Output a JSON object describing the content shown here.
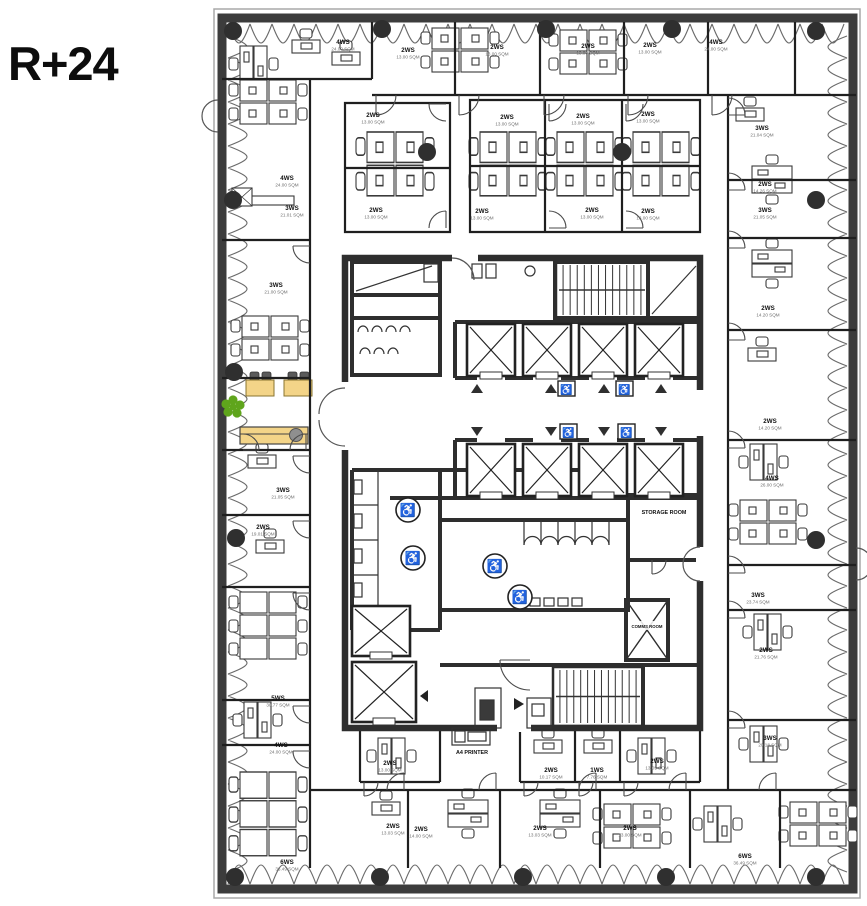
{
  "floor_label": "R+24",
  "colors": {
    "wall": "#3c3c3c",
    "frame": "#a8a8a8",
    "partition": "#1f1f1f",
    "core_wall": "#2e2e2e",
    "window_line": "#6a6a6a",
    "column": "#2f2f2f",
    "desk_line": "#3a3a3a",
    "door_line": "#4a4a4a",
    "highlight_fill": "#f3d488",
    "highlight_stroke": "#b99b45",
    "chair_dark": "#5a5a5a",
    "chair_gray": "#8f8f8f",
    "marker_green": "#5fa51c",
    "text_dark": "#111111",
    "text_gray": "#6f6f6f"
  },
  "core_labels": {
    "storage": "STORAGE ROOM",
    "comms": "COMMS ROOM",
    "printer": "A4 PRINTER"
  },
  "icons": {
    "wheelchair": "♿",
    "elevator_up": "up-triangle",
    "elevator_down": "down-triangle"
  },
  "rooms": [
    {
      "l": "4WS",
      "a": "24.00 SQM",
      "x": 343,
      "y": 44
    },
    {
      "l": "2WS",
      "a": "13.00 SQM",
      "x": 408,
      "y": 52
    },
    {
      "l": "2WS",
      "a": "13.00 SQM",
      "x": 497,
      "y": 49
    },
    {
      "l": "2WS",
      "a": "13.00 SQM",
      "x": 588,
      "y": 48
    },
    {
      "l": "2WS",
      "a": "13.00 SQM",
      "x": 650,
      "y": 47
    },
    {
      "l": "4WS",
      "a": "24.00 SQM",
      "x": 716,
      "y": 44
    },
    {
      "l": "2WS",
      "a": "13.00 SQM",
      "x": 373,
      "y": 117
    },
    {
      "l": "2WS",
      "a": "13.00 SQM",
      "x": 376,
      "y": 212
    },
    {
      "l": "2WS",
      "a": "13.00 SQM",
      "x": 507,
      "y": 119
    },
    {
      "l": "2WS",
      "a": "13.00 SQM",
      "x": 583,
      "y": 118
    },
    {
      "l": "2WS",
      "a": "13.00 SQM",
      "x": 648,
      "y": 116
    },
    {
      "l": "2WS",
      "a": "13.00 SQM",
      "x": 482,
      "y": 213
    },
    {
      "l": "2WS",
      "a": "13.00 SQM",
      "x": 592,
      "y": 212
    },
    {
      "l": "2WS",
      "a": "13.00 SQM",
      "x": 648,
      "y": 213
    },
    {
      "l": "4WS",
      "a": "24.00 SQM",
      "x": 287,
      "y": 180
    },
    {
      "l": "3WS",
      "a": "21.01 SQM",
      "x": 292,
      "y": 210
    },
    {
      "l": "3WS",
      "a": "21.00 SQM",
      "x": 276,
      "y": 287
    },
    {
      "l": "3WS",
      "a": "21.05 SQM",
      "x": 283,
      "y": 492
    },
    {
      "l": "2WS",
      "a": "19.01 SQM",
      "x": 263,
      "y": 529
    },
    {
      "l": "5WS",
      "a": "30.77 SQM",
      "x": 278,
      "y": 700
    },
    {
      "l": "4WS",
      "a": "24.00 SQM",
      "x": 281,
      "y": 747
    },
    {
      "l": "6WS",
      "a": "36.49 SQM",
      "x": 287,
      "y": 864
    },
    {
      "l": "3WS",
      "a": "21.04 SQM",
      "x": 762,
      "y": 130
    },
    {
      "l": "2WS",
      "a": "14.26 SQM",
      "x": 765,
      "y": 186
    },
    {
      "l": "3WS",
      "a": "21.05 SQM",
      "x": 765,
      "y": 212
    },
    {
      "l": "2WS",
      "a": "14.20 SQM",
      "x": 768,
      "y": 310
    },
    {
      "l": "2WS",
      "a": "14.20 SQM",
      "x": 770,
      "y": 423
    },
    {
      "l": "4WS",
      "a": "26.00 SQM",
      "x": 772,
      "y": 480
    },
    {
      "l": "3WS",
      "a": "23.74 SQM",
      "x": 758,
      "y": 597
    },
    {
      "l": "2WS",
      "a": "21.76 SQM",
      "x": 766,
      "y": 652
    },
    {
      "l": "3WS",
      "a": "20.18 SQM",
      "x": 770,
      "y": 740
    },
    {
      "l": "6WS",
      "a": "36.49 SQM",
      "x": 745,
      "y": 858
    },
    {
      "l": "2WS",
      "a": "13.00 SQM",
      "x": 390,
      "y": 765
    },
    {
      "l": "2WS",
      "a": "10.17 SQM",
      "x": 551,
      "y": 772
    },
    {
      "l": "1WS",
      "a": "7.76 SQM",
      "x": 597,
      "y": 772
    },
    {
      "l": "2WS",
      "a": "13.05 SQM",
      "x": 657,
      "y": 763
    },
    {
      "l": "2WS",
      "a": "13.03 SQM",
      "x": 393,
      "y": 828
    },
    {
      "l": "2WS",
      "a": "14.00 SQM",
      "x": 421,
      "y": 831
    },
    {
      "l": "2WS",
      "a": "13.03 SQM",
      "x": 540,
      "y": 830
    },
    {
      "l": "2WS",
      "a": "13.00 SQM",
      "x": 630,
      "y": 830
    }
  ],
  "columns": [
    [
      233,
      31
    ],
    [
      382,
      29
    ],
    [
      546,
      29
    ],
    [
      672,
      29
    ],
    [
      816,
      31
    ],
    [
      235,
      877
    ],
    [
      380,
      877
    ],
    [
      523,
      877
    ],
    [
      666,
      877
    ],
    [
      816,
      877
    ],
    [
      233,
      200
    ],
    [
      234,
      372
    ],
    [
      236,
      538
    ],
    [
      816,
      200
    ],
    [
      816,
      540
    ],
    [
      427,
      152
    ],
    [
      622,
      152
    ]
  ],
  "desks": [
    {
      "t": "ws2h",
      "x": 240,
      "y": 46
    },
    {
      "t": "ws1",
      "x": 292,
      "y": 40
    },
    {
      "t": "ws1",
      "x": 332,
      "y": 52
    },
    {
      "t": "ws4",
      "x": 240,
      "y": 80
    },
    {
      "t": "ws4",
      "x": 432,
      "y": 28
    },
    {
      "t": "ws4",
      "x": 560,
      "y": 30
    },
    {
      "t": "ws1",
      "x": 736,
      "y": 108
    },
    {
      "t": "ws2",
      "x": 752,
      "y": 166
    },
    {
      "t": "ws4",
      "x": 367,
      "y": 132,
      "sy": 1.45
    },
    {
      "t": "ws4",
      "x": 480,
      "y": 132,
      "sy": 1.45
    },
    {
      "t": "ws4",
      "x": 557,
      "y": 132,
      "sy": 1.45
    },
    {
      "t": "ws4",
      "x": 633,
      "y": 132,
      "sy": 1.45
    },
    {
      "t": "ws4",
      "x": 242,
      "y": 316
    },
    {
      "t": "ws1",
      "x": 248,
      "y": 455
    },
    {
      "t": "ws1",
      "x": 256,
      "y": 540
    },
    {
      "t": "ws6",
      "x": 240,
      "y": 592
    },
    {
      "t": "ws2h",
      "x": 244,
      "y": 702
    },
    {
      "t": "ws6",
      "x": 240,
      "y": 772,
      "sy": 1.25
    },
    {
      "t": "ws1",
      "x": 372,
      "y": 802
    },
    {
      "t": "ws2",
      "x": 448,
      "y": 800
    },
    {
      "t": "ws2",
      "x": 540,
      "y": 800
    },
    {
      "t": "ws4",
      "x": 604,
      "y": 804
    },
    {
      "t": "ws2h",
      "x": 704,
      "y": 806
    },
    {
      "t": "ws4",
      "x": 790,
      "y": 802
    },
    {
      "t": "ws2h",
      "x": 378,
      "y": 738
    },
    {
      "t": "ws1",
      "x": 534,
      "y": 740
    },
    {
      "t": "ws1",
      "x": 584,
      "y": 740
    },
    {
      "t": "ws2h",
      "x": 638,
      "y": 738
    },
    {
      "t": "ws2",
      "x": 752,
      "y": 250
    },
    {
      "t": "ws1",
      "x": 748,
      "y": 348
    },
    {
      "t": "ws2h",
      "x": 750,
      "y": 444
    },
    {
      "t": "ws4",
      "x": 740,
      "y": 500
    },
    {
      "t": "ws2h",
      "x": 754,
      "y": 614
    },
    {
      "t": "ws2h",
      "x": 750,
      "y": 726
    }
  ],
  "elevators": [
    {
      "x": 467,
      "y": 324,
      "w": 48,
      "h": 52
    },
    {
      "x": 523,
      "y": 324,
      "w": 48,
      "h": 52
    },
    {
      "x": 579,
      "y": 324,
      "w": 48,
      "h": 52
    },
    {
      "x": 635,
      "y": 324,
      "w": 48,
      "h": 52
    },
    {
      "x": 467,
      "y": 444,
      "w": 48,
      "h": 52
    },
    {
      "x": 523,
      "y": 444,
      "w": 48,
      "h": 52
    },
    {
      "x": 579,
      "y": 444,
      "w": 48,
      "h": 52
    },
    {
      "x": 635,
      "y": 444,
      "w": 48,
      "h": 52
    },
    {
      "x": 352,
      "y": 606,
      "w": 58,
      "h": 50
    },
    {
      "x": 352,
      "y": 662,
      "w": 64,
      "h": 60
    }
  ],
  "indicators": {
    "up": [
      [
        477,
        389
      ],
      [
        551,
        389
      ],
      [
        604,
        389
      ],
      [
        661,
        389
      ]
    ],
    "down": [
      [
        477,
        431
      ],
      [
        551,
        431
      ],
      [
        604,
        431
      ],
      [
        661,
        431
      ]
    ],
    "lobby_wc": [
      [
        558,
        381
      ],
      [
        616,
        381
      ],
      [
        560,
        424
      ],
      [
        618,
        424
      ]
    ],
    "bath_wc": [
      [
        408,
        510
      ],
      [
        413,
        558
      ],
      [
        495,
        566
      ],
      [
        520,
        597
      ]
    ]
  },
  "doors": [
    [
      376,
      95,
      20,
      0
    ],
    [
      459,
      95,
      20,
      0
    ],
    [
      544,
      95,
      20,
      0
    ],
    [
      628,
      95,
      20,
      0
    ],
    [
      712,
      95,
      20,
      0
    ],
    [
      446,
      104,
      17,
      90
    ],
    [
      446,
      228,
      17,
      180
    ],
    [
      549,
      104,
      17,
      0
    ],
    [
      626,
      104,
      17,
      0
    ],
    [
      549,
      228,
      17,
      270
    ],
    [
      626,
      228,
      17,
      270
    ],
    [
      310,
      246,
      17,
      90
    ],
    [
      310,
      456,
      17,
      90
    ],
    [
      310,
      521,
      17,
      90
    ],
    [
      310,
      593,
      17,
      90
    ],
    [
      310,
      706,
      17,
      90
    ],
    [
      310,
      751,
      17,
      90
    ],
    [
      243,
      450,
      16,
      270
    ],
    [
      306,
      450,
      16,
      180
    ],
    [
      728,
      115,
      17,
      270
    ],
    [
      728,
      190,
      17,
      270
    ],
    [
      728,
      248,
      17,
      270
    ],
    [
      728,
      340,
      17,
      270
    ],
    [
      728,
      448,
      17,
      270
    ],
    [
      728,
      573,
      17,
      270
    ],
    [
      728,
      618,
      17,
      270
    ],
    [
      728,
      728,
      17,
      270
    ],
    [
      404,
      790,
      17,
      180
    ],
    [
      496,
      790,
      17,
      180
    ],
    [
      596,
      790,
      17,
      180
    ],
    [
      686,
      790,
      17,
      180
    ],
    [
      776,
      790,
      17,
      180
    ],
    [
      364,
      782,
      14,
      0
    ],
    [
      524,
      782,
      14,
      0
    ],
    [
      579,
      782,
      14,
      0
    ],
    [
      624,
      782,
      14,
      0
    ],
    [
      530,
      660,
      30,
      90
    ],
    [
      652,
      560,
      14,
      0
    ]
  ],
  "marker": {
    "x": 233,
    "y": 407
  }
}
